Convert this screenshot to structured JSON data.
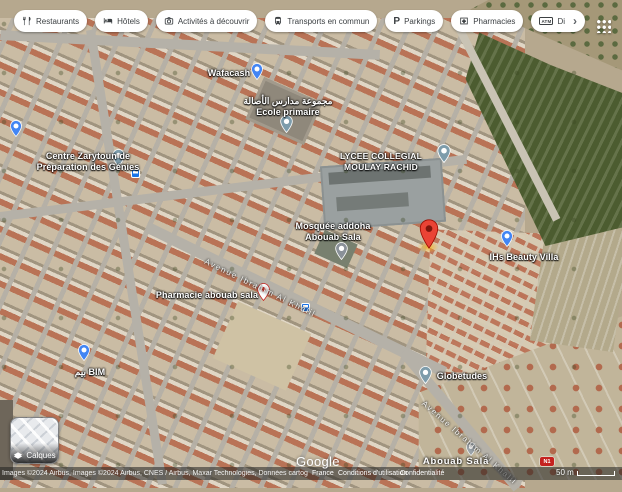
{
  "chips": {
    "restaurants": "Restaurants",
    "hotels": "Hôtels",
    "activities": "Activités à découvrir",
    "transit": "Transports en commun",
    "parkings": "Parkings",
    "pharmacies": "Pharmacies",
    "atm_truncated": "Di"
  },
  "icons": {
    "parking_glyph": "P",
    "atm_glyph": "ATM",
    "chevron_right": "›"
  },
  "map": {
    "pois": {
      "wafacash": "Wafacash",
      "school_arabic": "مجموعة مدارس الأصالة",
      "school_french": "Ecole primaire",
      "centre_line1": "Centre Zarytoun de",
      "centre_line2": "Préparation des Génies",
      "lycee_line1": "LYCEE COLLEGIAL",
      "lycee_line2": "MOULAY RACHID",
      "mosque_line1": "Mosquée addoha",
      "mosque_line2": "Abouab Sala",
      "beauty_villa": "IHs Beauty Villa",
      "pharmacy": "Pharmacie abouab sala",
      "bim": "بيم BIM",
      "globetudes": "Globetudes",
      "locality": "Abouab Sala",
      "road_badge": "N1"
    },
    "streets": {
      "avenue_center": "Avenue Ibrahim Al Khalil",
      "avenue_southeast": "Avenue Ibrahim Al Khalil"
    }
  },
  "layers_button": {
    "label": "Calques"
  },
  "footer": {
    "logo": "Google",
    "attribution": "Images ©2024 Airbus, Images ©2024 Airbus, CNES / Airbus, Maxar Technologies, Données cartographiques ©2024",
    "region_link": "France",
    "terms_link": "Conditions d'utilisation",
    "privacy_link": "Confidentialité",
    "scale": "50 m"
  },
  "colors": {
    "pin_blue": "#4285f4",
    "pin_red": "#ea4335",
    "chip_text": "#3c4043"
  }
}
